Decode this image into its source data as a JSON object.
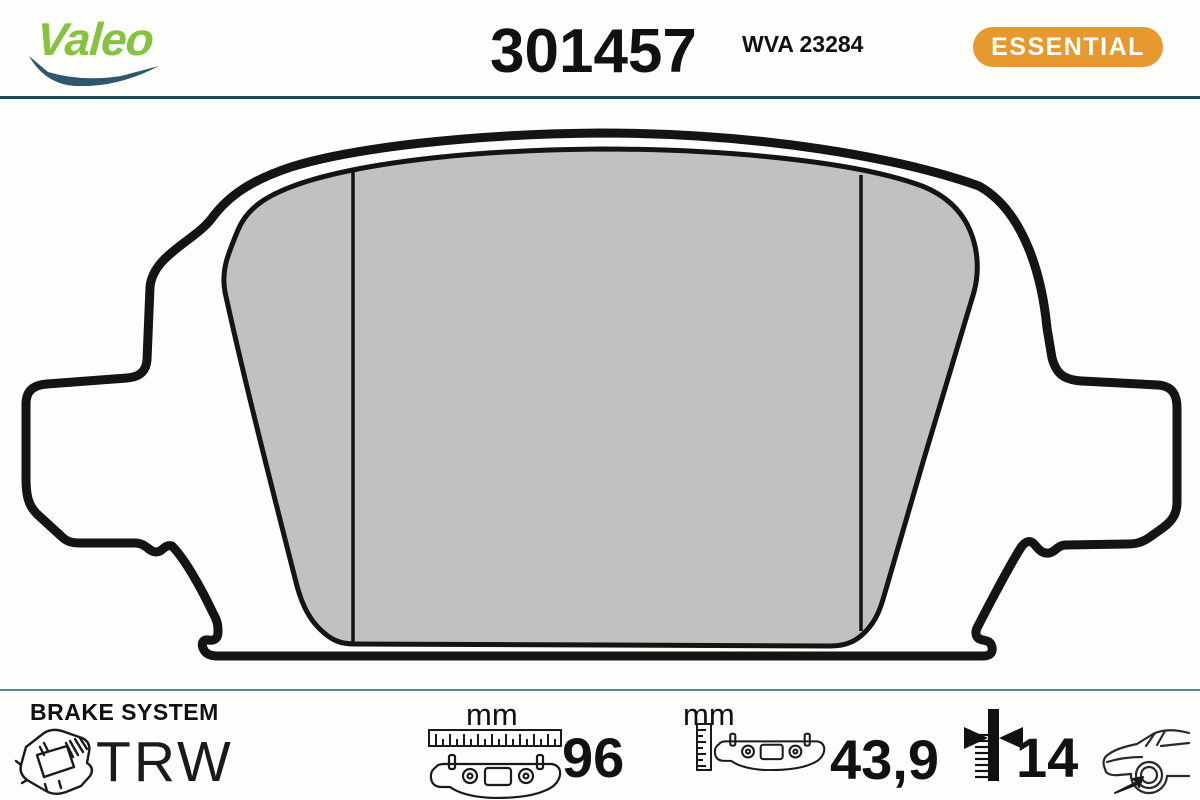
{
  "header": {
    "brand_logo": "Valeo",
    "part_number": "301457",
    "wva_number": "WVA 23284",
    "range_badge": "ESSENTIAL"
  },
  "drawing": {
    "subject": "brake pad outline with friction material"
  },
  "footer": {
    "system_label": "BRAKE SYSTEM",
    "system_brand": "TRW",
    "measurements": [
      {
        "name": "width",
        "unit": "mm",
        "value": "96"
      },
      {
        "name": "height",
        "unit": "mm",
        "value": "43,9"
      },
      {
        "name": "thickness",
        "unit": "",
        "value": "14"
      }
    ]
  },
  "colors": {
    "valeo_green": "#85C23E",
    "swoosh_navy": "#31566B",
    "badge_orange": "#E5992E",
    "header_rule": "#1D4A5F",
    "footer_rule": "#4B8E9B",
    "pad_gray": "#C1C1BF",
    "line_black": "#141414"
  }
}
